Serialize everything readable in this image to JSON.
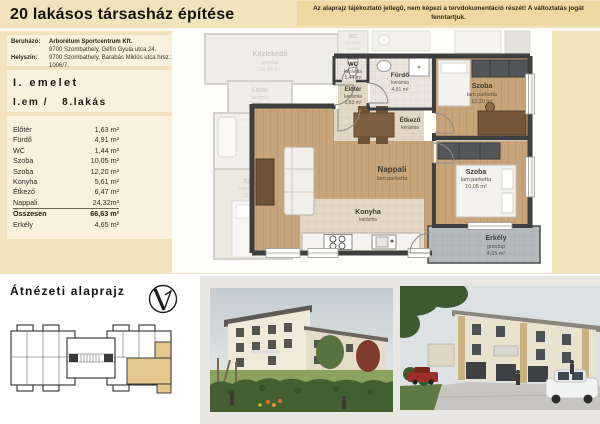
{
  "header": {
    "title": "20 lakásos társasház építése",
    "disclaimer": "Az alaprajz tájékoztató jellegű, nem képezi a tervdokumentáció részét! A változtatás jogát fenntartjuk."
  },
  "project": {
    "developer_label": "Beruházó:",
    "developer_name": "Arborétum Sportcentrum Kft.",
    "developer_address": "9700 Szombathely, Géfin Gyula utca 24.",
    "site_label": "Helyszín:",
    "site_address": "9700 Szombathely, Barabás Miklós utca hrsz.: 1006/7."
  },
  "unit": {
    "floor": "I. emelet",
    "level": "I.em /",
    "flat": "8.lakás"
  },
  "area_table": {
    "rows": [
      {
        "name": "Előtér",
        "area": "1,63 m²"
      },
      {
        "name": "Fürdő",
        "area": "4,91 m²"
      },
      {
        "name": "WC",
        "area": "1,44 m²"
      },
      {
        "name": "Szoba",
        "area": "10,05 m²"
      },
      {
        "name": "Szoba",
        "area": "12,20 m²"
      },
      {
        "name": "Konyha",
        "area": "5,61 m²"
      },
      {
        "name": "Étkező",
        "area": "6,47 m²"
      },
      {
        "name": "Nappali",
        "area": "24,32m²"
      }
    ],
    "total_name": "Összesen",
    "total_area": "66,63 m²",
    "balcony_name": "Erkély",
    "balcony_area": "4,65 m²"
  },
  "plan": {
    "wc": {
      "name": "WC",
      "mat": "kerámia",
      "area": "1,44 m²"
    },
    "eloter": {
      "name": "Előtér",
      "mat": "kerámia",
      "area": "1,63 m²"
    },
    "furdo": {
      "name": "Fürdő",
      "mat": "kerámia",
      "area": "4,91 m²"
    },
    "szoba1": {
      "name": "Szoba",
      "mat": "lam.parketta",
      "area": "12,20 m²"
    },
    "etkezo": {
      "name": "Étkező",
      "mat": "kerámia"
    },
    "nappali": {
      "name": "Nappali",
      "mat": "lam.parketta"
    },
    "konyha": {
      "name": "Konyha",
      "mat": "kerámia"
    },
    "szoba2": {
      "name": "Szoba",
      "mat": "lam.parketta",
      "area": "10,05 m²"
    },
    "erkely": {
      "name": "Erkély",
      "mat": "greslap",
      "area": "4,65 m²"
    },
    "neighbor": {
      "kozlekedo": {
        "name": "Közlekedő",
        "mat": "greslap",
        "area": "16,46 m²"
      },
      "eloter": {
        "name": "Előtér",
        "mat": "kerámia",
        "area": "1,73 m²"
      },
      "furdo": {
        "name": "Fürdő",
        "mat": "kerámia",
        "area": "6,10 m²"
      },
      "szoba": {
        "name": "Szoba",
        "mat": "lam.parketta",
        "area": "11,60 m²"
      },
      "wc_upper": {
        "name": "WC",
        "mat": "kerámia",
        "area": "1,44 m²"
      }
    }
  },
  "overview": {
    "heading": "Átnézeti alaprajz"
  },
  "colors": {
    "page_bg": "#f2e3bd",
    "panel_bg": "#f9f1dd",
    "disclaimer_bg": "#eed9a2",
    "highlight": "#e6c88f",
    "wall": "#3e3e3e",
    "wood": "#c8a47a",
    "balcony_gray": "#b5b9bc"
  }
}
